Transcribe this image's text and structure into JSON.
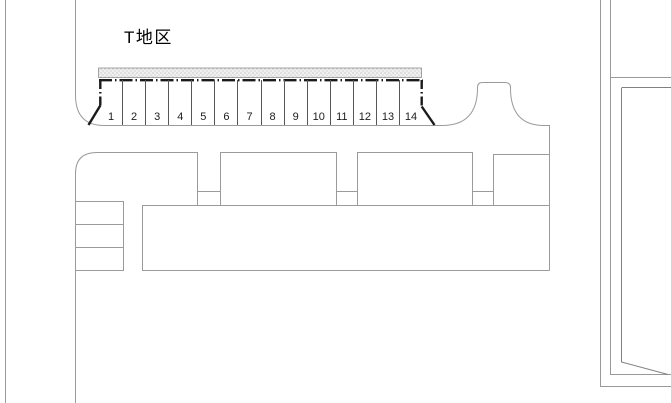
{
  "diagram": {
    "district_label": "T地区",
    "stalls": {
      "count": 14,
      "numbers": [
        "1",
        "2",
        "3",
        "4",
        "5",
        "6",
        "7",
        "8",
        "9",
        "10",
        "11",
        "12",
        "13",
        "14"
      ]
    },
    "colors": {
      "background": "#ffffff",
      "road_line": "#9b9b9b",
      "parcel_line": "#999999",
      "right_block_line": "#808080",
      "stall_divider": "#575757",
      "boundary_thick": "#1a1a1a",
      "hatch_background": "#f0f0f0",
      "hatch_dot": "#999999",
      "label_text": "#000000"
    }
  }
}
